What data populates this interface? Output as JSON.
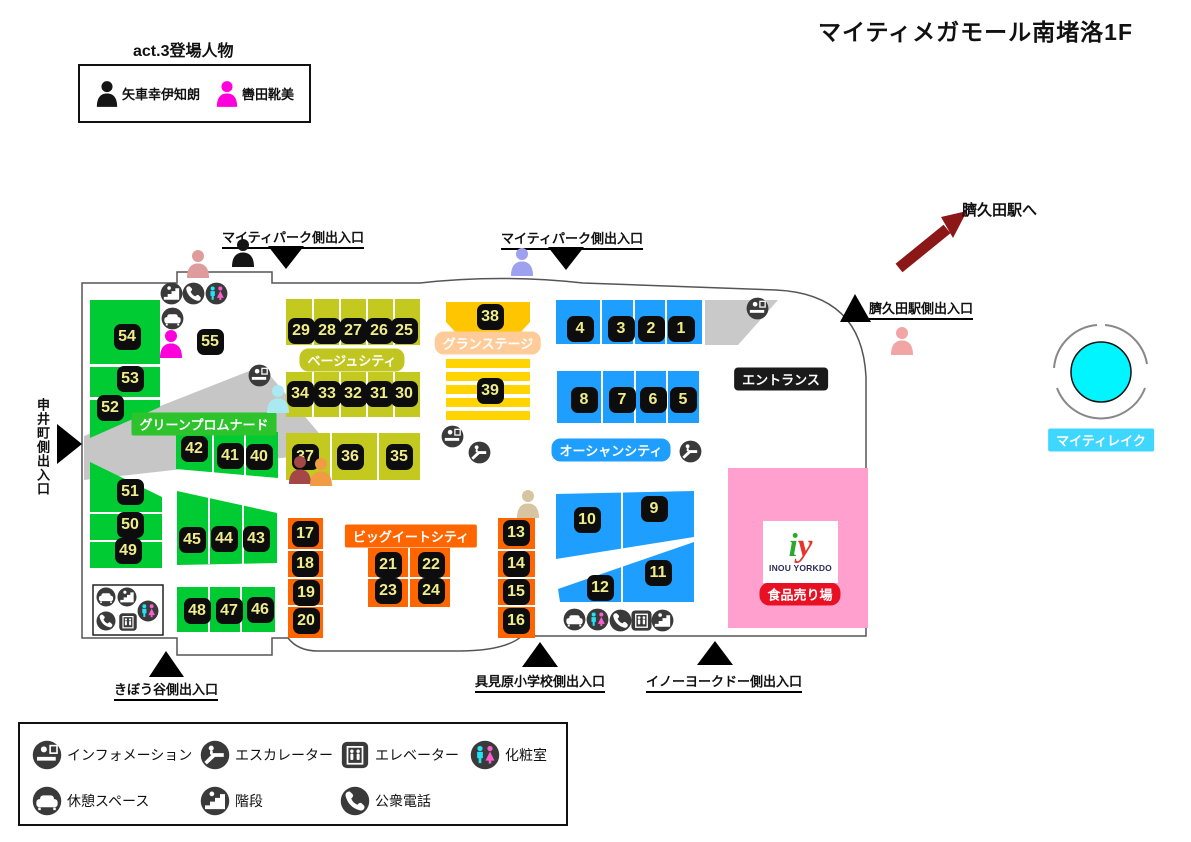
{
  "title": "マイティメガモール南堵洛1F",
  "act3": {
    "heading": "act.3登場人物",
    "characters": [
      {
        "name": "矢車幸伊知朗",
        "color": "#151515"
      },
      {
        "name": "轡田靴美",
        "color": "#FF00DD"
      }
    ]
  },
  "station_note": "臍久田駅へ",
  "yorkdo": {
    "logo_i": "i",
    "logo_y": "y",
    "logo_name": "INOU YORKDO",
    "badge_label": "食品売り場"
  },
  "colors": {
    "green": "#00CB32",
    "beige": "#C4C91F",
    "gold": "#FFC600",
    "gold2": "#FFD400",
    "blue": "#1E9FFF",
    "orange": "#FF6600",
    "pink": "#FFA0CE",
    "gray": "#C9C9C9",
    "gray2": "#C6C6C6",
    "white": "#FFFFFF",
    "chip_bg": "#0D0D0D",
    "chip_text": "#EFEC8B",
    "arrow_red": "#8B1717",
    "lake": "#00F5FF"
  },
  "area_labels": [
    {
      "text": "ベージュシティ",
      "x": 352,
      "y": 360,
      "bg": "#C0C520",
      "r": 9
    },
    {
      "text": "グランステージ",
      "x": 488,
      "y": 343,
      "bg": "#FFCC99",
      "r": 9
    },
    {
      "text": "グリーンプロムナード",
      "x": 204,
      "y": 424,
      "bg": "#2CC32C",
      "r": 2
    },
    {
      "text": "オーシャンシティ",
      "x": 611,
      "y": 450,
      "bg": "#1E9FFF",
      "r": 9
    },
    {
      "text": "ビッグイートシティ",
      "x": 411,
      "y": 536,
      "bg": "#FF6600",
      "r": 2
    },
    {
      "text": "エントランス",
      "x": 781,
      "y": 379,
      "bg": "#1A1A1A",
      "r": 4
    },
    {
      "text": "マイティレイク",
      "x": 1101,
      "y": 440,
      "bg": "#3FD6FF",
      "r": 2
    },
    {
      "text": "食品売り場",
      "x": 800,
      "y": 594,
      "bg": "#E81123",
      "r": 10
    }
  ],
  "exits": [
    {
      "text": "マイティパーク側出入口",
      "x": 293,
      "y": 227,
      "vertical": false
    },
    {
      "text": "マイティパーク側出入口",
      "x": 572,
      "y": 228,
      "vertical": false
    },
    {
      "text": "臍久田駅側出入口",
      "x": 921,
      "y": 298,
      "vertical": false
    },
    {
      "text": "申井町側出入口",
      "x": 33,
      "y": 398,
      "vertical": true
    },
    {
      "text": "きぼう谷側出入口",
      "x": 166,
      "y": 679,
      "vertical": false
    },
    {
      "text": "具見原小学校側出入口",
      "x": 540,
      "y": 671,
      "vertical": false
    },
    {
      "text": "イノーヨークドー側出入口",
      "x": 724,
      "y": 671,
      "vertical": false
    }
  ],
  "triangles": [
    "268,246 304,246 286,269",
    "548,247 584,247 566,270",
    "855,294 840,322 871,322",
    "57,424 57,464 82,444",
    "166,651 149,677 184,677",
    "540,642 522,667 558,667",
    "715,641 697,665 733,665"
  ],
  "blocks": [
    {
      "n": "1",
      "x": 681,
      "y": 329
    },
    {
      "n": "2",
      "x": 651,
      "y": 329
    },
    {
      "n": "3",
      "x": 621,
      "y": 329
    },
    {
      "n": "4",
      "x": 580,
      "y": 329
    },
    {
      "n": "5",
      "x": 683,
      "y": 400
    },
    {
      "n": "6",
      "x": 653,
      "y": 400
    },
    {
      "n": "7",
      "x": 622,
      "y": 400
    },
    {
      "n": "8",
      "x": 584,
      "y": 400
    },
    {
      "n": "9",
      "x": 654,
      "y": 509
    },
    {
      "n": "10",
      "x": 587,
      "y": 520
    },
    {
      "n": "11",
      "x": 658,
      "y": 573
    },
    {
      "n": "12",
      "x": 600,
      "y": 588
    },
    {
      "n": "13",
      "x": 516,
      "y": 533
    },
    {
      "n": "14",
      "x": 516,
      "y": 564
    },
    {
      "n": "15",
      "x": 516,
      "y": 592
    },
    {
      "n": "16",
      "x": 516,
      "y": 621
    },
    {
      "n": "17",
      "x": 305,
      "y": 534
    },
    {
      "n": "18",
      "x": 305,
      "y": 564
    },
    {
      "n": "19",
      "x": 306,
      "y": 593
    },
    {
      "n": "20",
      "x": 306,
      "y": 621
    },
    {
      "n": "21",
      "x": 388,
      "y": 565
    },
    {
      "n": "22",
      "x": 431,
      "y": 565
    },
    {
      "n": "23",
      "x": 388,
      "y": 591
    },
    {
      "n": "24",
      "x": 431,
      "y": 591
    },
    {
      "n": "25",
      "x": 404,
      "y": 331
    },
    {
      "n": "26",
      "x": 379,
      "y": 331
    },
    {
      "n": "27",
      "x": 353,
      "y": 331
    },
    {
      "n": "28",
      "x": 327,
      "y": 331
    },
    {
      "n": "29",
      "x": 301,
      "y": 331
    },
    {
      "n": "30",
      "x": 404,
      "y": 394
    },
    {
      "n": "31",
      "x": 379,
      "y": 394
    },
    {
      "n": "32",
      "x": 353,
      "y": 394
    },
    {
      "n": "33",
      "x": 327,
      "y": 394
    },
    {
      "n": "34",
      "x": 300,
      "y": 394
    },
    {
      "n": "35",
      "x": 399,
      "y": 457
    },
    {
      "n": "36",
      "x": 350,
      "y": 457
    },
    {
      "n": "37",
      "x": 305,
      "y": 457
    },
    {
      "n": "38",
      "x": 490,
      "y": 317
    },
    {
      "n": "39",
      "x": 490,
      "y": 391
    },
    {
      "n": "40",
      "x": 259,
      "y": 457
    },
    {
      "n": "41",
      "x": 230,
      "y": 456
    },
    {
      "n": "42",
      "x": 194,
      "y": 449
    },
    {
      "n": "43",
      "x": 256,
      "y": 539
    },
    {
      "n": "44",
      "x": 224,
      "y": 539
    },
    {
      "n": "45",
      "x": 192,
      "y": 540
    },
    {
      "n": "46",
      "x": 260,
      "y": 610
    },
    {
      "n": "47",
      "x": 229,
      "y": 611
    },
    {
      "n": "48",
      "x": 197,
      "y": 611
    },
    {
      "n": "49",
      "x": 128,
      "y": 551
    },
    {
      "n": "50",
      "x": 130,
      "y": 525
    },
    {
      "n": "51",
      "x": 130,
      "y": 492
    },
    {
      "n": "52",
      "x": 110,
      "y": 408
    },
    {
      "n": "53",
      "x": 130,
      "y": 379
    },
    {
      "n": "54",
      "x": 127,
      "y": 337
    },
    {
      "n": "55",
      "x": 210,
      "y": 342
    }
  ],
  "shapes": [
    {
      "t": "p",
      "pts": "84,436 262,366 335,452 84,480",
      "f": "gray2"
    },
    {
      "t": "p",
      "pts": "705,300 778,300 738,345 705,345",
      "f": "gray"
    },
    {
      "t": "r",
      "x": 90,
      "y": 300,
      "w": 70,
      "h": 64,
      "f": "green"
    },
    {
      "t": "r",
      "x": 90,
      "y": 367,
      "w": 70,
      "h": 30,
      "f": "green"
    },
    {
      "t": "p",
      "pts": "90,400 160,400 160,407 90,438",
      "f": "green"
    },
    {
      "t": "p",
      "pts": "90,462 162,497 162,512 90,512",
      "f": "green"
    },
    {
      "t": "r",
      "x": 90,
      "y": 514,
      "w": 72,
      "h": 26,
      "f": "green"
    },
    {
      "t": "r",
      "x": 90,
      "y": 542,
      "w": 72,
      "h": 26,
      "f": "green"
    },
    {
      "t": "p",
      "pts": "176,431 278,432 278,478 176,469",
      "f": "green"
    },
    {
      "t": "p",
      "pts": "177,491 277,513 277,563 177,565",
      "f": "green"
    },
    {
      "t": "r",
      "x": 177,
      "y": 587,
      "w": 98,
      "h": 45,
      "f": "green"
    },
    {
      "t": "r",
      "x": 286,
      "y": 299,
      "w": 134,
      "h": 46,
      "f": "beige"
    },
    {
      "t": "r",
      "x": 286,
      "y": 372,
      "w": 134,
      "h": 45,
      "f": "beige"
    },
    {
      "t": "r",
      "x": 286,
      "y": 433,
      "w": 134,
      "h": 47,
      "f": "beige"
    },
    {
      "t": "p",
      "pts": "446,302 530,302 530,322 519,334 457,334 446,322",
      "f": "gold"
    },
    {
      "t": "r",
      "x": 446,
      "y": 359,
      "w": 84,
      "h": 9,
      "f": "gold2"
    },
    {
      "t": "r",
      "x": 446,
      "y": 372,
      "w": 84,
      "h": 9,
      "f": "gold2"
    },
    {
      "t": "r",
      "x": 446,
      "y": 385,
      "w": 84,
      "h": 9,
      "f": "gold2"
    },
    {
      "t": "r",
      "x": 446,
      "y": 398,
      "w": 84,
      "h": 9,
      "f": "gold2"
    },
    {
      "t": "r",
      "x": 446,
      "y": 411,
      "w": 84,
      "h": 9,
      "f": "gold2"
    },
    {
      "t": "r",
      "x": 556,
      "y": 300,
      "w": 146,
      "h": 44,
      "f": "blue"
    },
    {
      "t": "r",
      "x": 557,
      "y": 371,
      "w": 142,
      "h": 52,
      "f": "blue"
    },
    {
      "t": "p",
      "pts": "556,494 694,491 694,537 556,559",
      "f": "blue"
    },
    {
      "t": "p",
      "pts": "558,589 694,542 694,602 560,602",
      "f": "blue"
    },
    {
      "t": "r",
      "x": 288,
      "y": 518,
      "w": 35,
      "h": 120,
      "f": "orange"
    },
    {
      "t": "r",
      "x": 498,
      "y": 518,
      "w": 37,
      "h": 120,
      "f": "orange"
    },
    {
      "t": "r",
      "x": 368,
      "y": 548,
      "w": 82,
      "h": 59,
      "f": "orange"
    },
    {
      "t": "r",
      "x": 728,
      "y": 468,
      "w": 140,
      "h": 160,
      "f": "pink"
    },
    {
      "t": "r",
      "x": 93,
      "y": 585,
      "w": 70,
      "h": 50,
      "f": "white",
      "s": "#222"
    }
  ],
  "dividers": [
    [
      313,
      299,
      313,
      345
    ],
    [
      340,
      299,
      340,
      345
    ],
    [
      367,
      299,
      367,
      345
    ],
    [
      394,
      299,
      394,
      345
    ],
    [
      313,
      372,
      313,
      417
    ],
    [
      340,
      372,
      340,
      417
    ],
    [
      367,
      372,
      367,
      417
    ],
    [
      394,
      372,
      394,
      417
    ],
    [
      331,
      433,
      331,
      480
    ],
    [
      378,
      433,
      378,
      480
    ],
    [
      601,
      300,
      601,
      344
    ],
    [
      634,
      300,
      634,
      344
    ],
    [
      666,
      300,
      666,
      344
    ],
    [
      602,
      371,
      602,
      423
    ],
    [
      635,
      371,
      635,
      423
    ],
    [
      667,
      371,
      667,
      423
    ],
    [
      622,
      491,
      622,
      559
    ],
    [
      622,
      542,
      622,
      602
    ],
    [
      288,
      550,
      323,
      550
    ],
    [
      288,
      578,
      323,
      578
    ],
    [
      288,
      606,
      323,
      606
    ],
    [
      498,
      550,
      535,
      550
    ],
    [
      498,
      578,
      535,
      578
    ],
    [
      498,
      606,
      535,
      606
    ],
    [
      409,
      548,
      409,
      607
    ],
    [
      368,
      578,
      450,
      578
    ],
    [
      213,
      432,
      213,
      475
    ],
    [
      245,
      432,
      245,
      477
    ],
    [
      209,
      498,
      209,
      564
    ],
    [
      243,
      505,
      243,
      564
    ],
    [
      209,
      587,
      209,
      632
    ],
    [
      241,
      587,
      241,
      632
    ]
  ],
  "outline": "M177,272 H272 V283 H420 Q500,274 583,283 L776,290 Q862,294 866,377 V636 H522 Q505,651 458,651 H318 Q298,651 288,638 H272 V655 H177 V638 H82 V283 H177 Z",
  "icons": [
    {
      "type": "stairs",
      "x": 171,
      "y": 293
    },
    {
      "type": "phone",
      "x": 193,
      "y": 293
    },
    {
      "type": "restroom",
      "x": 216,
      "y": 293
    },
    {
      "type": "rest",
      "x": 172,
      "y": 318
    },
    {
      "type": "info",
      "x": 259,
      "y": 375
    },
    {
      "type": "info",
      "x": 452,
      "y": 436
    },
    {
      "type": "escalator",
      "x": 479,
      "y": 452
    },
    {
      "type": "info",
      "x": 757,
      "y": 308
    },
    {
      "type": "escalator",
      "x": 690,
      "y": 451
    },
    {
      "type": "rest",
      "x": 106,
      "y": 597,
      "s": 20
    },
    {
      "type": "stairs",
      "x": 127,
      "y": 597,
      "s": 20
    },
    {
      "type": "restroom",
      "x": 148,
      "y": 611,
      "s": 22
    },
    {
      "type": "phone",
      "x": 106,
      "y": 621,
      "s": 20
    },
    {
      "type": "elevator",
      "x": 128,
      "y": 622,
      "s": 20
    },
    {
      "type": "rest",
      "x": 574,
      "y": 619
    },
    {
      "type": "restroom",
      "x": 597,
      "y": 619
    },
    {
      "type": "phone",
      "x": 620,
      "y": 620
    },
    {
      "type": "elevator",
      "x": 641,
      "y": 620
    },
    {
      "type": "stairs",
      "x": 662,
      "y": 620
    }
  ],
  "persons": [
    {
      "color": "#DE9C9C",
      "x": 198,
      "y": 263
    },
    {
      "color": "#151515",
      "x": 243,
      "y": 252
    },
    {
      "color": "#9EA0F0",
      "x": 522,
      "y": 261
    },
    {
      "color": "#F2A5A5",
      "x": 902,
      "y": 340
    },
    {
      "color": "#FF00DD",
      "x": 171,
      "y": 343
    },
    {
      "color": "#ABE9F2",
      "x": 278,
      "y": 398
    },
    {
      "color": "#A34747",
      "x": 300,
      "y": 469
    },
    {
      "color": "#F29B45",
      "x": 321,
      "y": 471
    },
    {
      "color": "#D7C5A2",
      "x": 528,
      "y": 503
    }
  ],
  "legend": {
    "items": [
      {
        "icon": "info",
        "label": "インフォメーション"
      },
      {
        "icon": "escalator",
        "label": "エスカレーター"
      },
      {
        "icon": "elevator",
        "label": "エレベーター"
      },
      {
        "icon": "restroom",
        "label": "化粧室"
      },
      {
        "icon": "rest",
        "label": "休憩スペース"
      },
      {
        "icon": "stairs",
        "label": "階段"
      },
      {
        "icon": "phone",
        "label": "公衆電話"
      }
    ]
  }
}
